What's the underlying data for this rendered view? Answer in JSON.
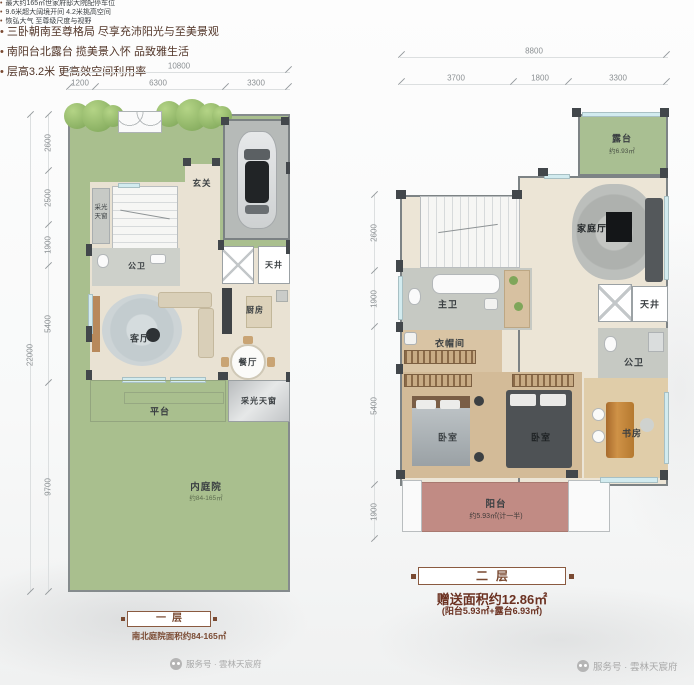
{
  "watermark": {
    "icon": "wechat-icon",
    "label": "服务号 · 雲林天宸府"
  },
  "colors": {
    "garden_green": "#a9bf8e",
    "balcony_rose": "#c18b84",
    "accent_maroon": "#7a4a32",
    "wall_dark": "#42474b",
    "window_blue": "#d2ebef"
  },
  "floor1": {
    "title": "一层",
    "subtitle": "南北庭院面积约84-165㎡",
    "bullets": [
      "最大约165㎡世家府邸大院配停车位",
      "9.6米超大阔境开间 4.2米挑高空间",
      "恢弘大气 至尊级尺度与视野"
    ],
    "dims": {
      "total_width": "10800",
      "width_segments": [
        "1200",
        "6300",
        "3300"
      ],
      "total_height": "22000",
      "height_segments": [
        "2600",
        "2500",
        "1900",
        "5400",
        "9700"
      ]
    },
    "rooms": {
      "entry": "玄关",
      "skylight_side_1": "采光",
      "skylight_side_2": "天窗",
      "bath": "公卫",
      "lightwell": "天井",
      "kitchen": "厨房",
      "living": "客厅",
      "dining": "餐厅",
      "platform": "平台",
      "skylight_south": "采光天窗",
      "courtyard": "内庭院",
      "courtyard_area": "约84-165㎡"
    }
  },
  "floor2": {
    "title": "二层",
    "gift_area": "赠送面积约12.86㎡",
    "gift_note": "(阳台5.93㎡+露台6.93㎡)",
    "bullets": [
      "三卧朝南至尊格局 尽享充沛阳光与至美景观",
      "南阳台北露台 揽美景入怀 品致雅生活",
      "层高3.2米 更高效空间利用率"
    ],
    "dims": {
      "total_width": "8800",
      "width_segments": [
        "3700",
        "1800",
        "3300"
      ],
      "height_segments": [
        "2600",
        "1900",
        "5400",
        "1900"
      ]
    },
    "rooms": {
      "terrace": "露台",
      "terrace_area": "约6.93㎡",
      "family": "家庭厅",
      "master_bath": "主卫",
      "lightwell": "天井",
      "closet": "衣帽间",
      "bath": "公卫",
      "bedroom_1": "卧室",
      "bedroom_2": "卧室",
      "study": "书房",
      "balcony": "阳台",
      "balcony_area": "约5.93㎡(计一半)"
    }
  }
}
